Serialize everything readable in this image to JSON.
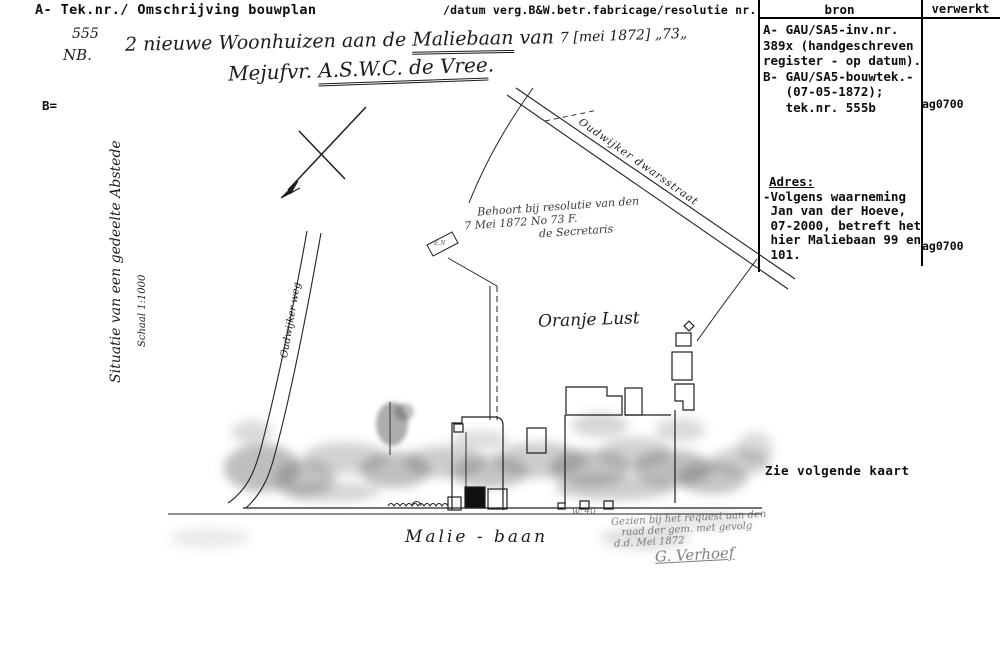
{
  "header": {
    "left": "A- Tek.nr./ Omschrijving bouwplan",
    "middle": "/datum verg.B&W.betr.fabricage/resolutie nr.",
    "col_bron": "bron",
    "col_verwerkt": "verwerkt"
  },
  "handwritten": {
    "number": "555",
    "nb": "NB.",
    "b_mark": "B=",
    "title1_pre": "2 nieuwe Woonhuizen aan de ",
    "title1_u": "Maliebaan",
    "title1_post": " van",
    "title2_pre": "Mejufvr. ",
    "title2_u": "A.S.W.C. de Vree",
    "title2_post": ".",
    "date_note": "7 [mei 1872] „73„"
  },
  "source_panel": {
    "bron_lines": [
      "A- GAU/SA5-inv.nr.",
      "389x (handgeschreven",
      "register - op datum).",
      "B- GAU/SA5-bouwtek.-",
      "   (07-05-1872);",
      "   tek.nr. 555b"
    ],
    "verwerkt1": "ag0700",
    "adres_heading": "Adres:",
    "adres_lines": [
      "-Volgens waarneming",
      " Jan van der Hoeve,",
      " 07-2000, betreft het",
      " hier Maliebaan 99 en",
      " 101."
    ],
    "verwerkt2": "ag0700",
    "see_next": "Zie volgende kaart"
  },
  "map_labels": {
    "side_label": "Situatie van een gedeelte Abstede",
    "scale_label": "Schaal 1:1000",
    "road_left": "Oudwijker weg",
    "road_diag": "Oudwijker dwarsstraat",
    "resolution_l1": "Behoort bij resolutie van den",
    "resolution_l2": "7 Mei 1872 No 73 F.",
    "resolution_l3": "de Secretaris",
    "area_label": "Oranje Lust",
    "street_label": "Malie - baan",
    "en_label": "E.N",
    "w40": "w. 40",
    "note_l1": "Gezien bij het request aan den",
    "note_l2": "raad der gem. met gevolg",
    "note_l3": "d.d. Mei 1872",
    "signature": "G. Verhoef"
  }
}
